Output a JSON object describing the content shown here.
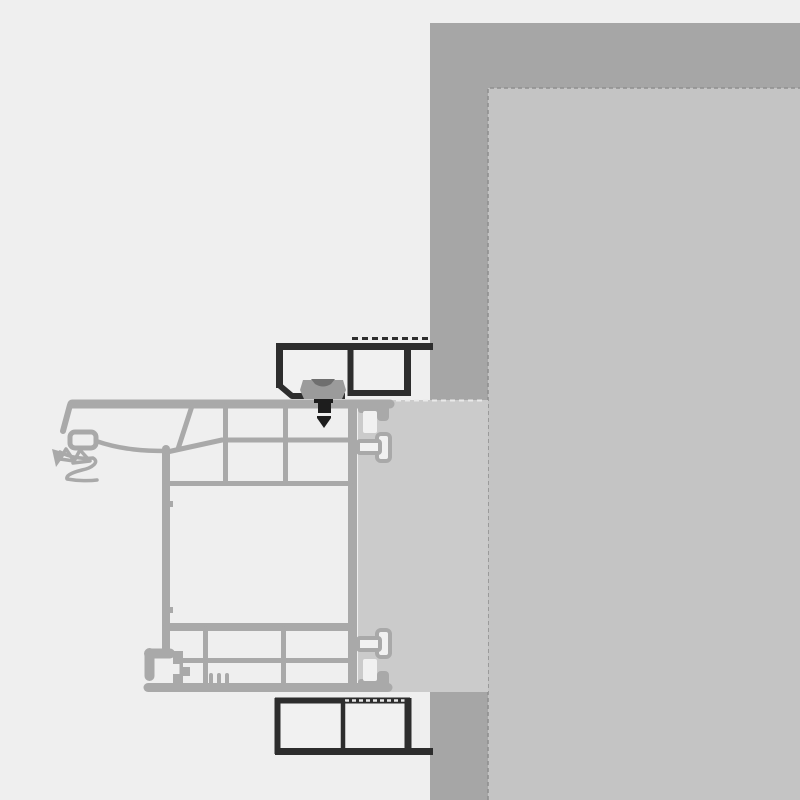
{
  "drawing": {
    "kind": "technical-cross-section",
    "subject": "window-frame-installation-detail",
    "components": {
      "wall": "masonry-wall",
      "wall_inner": "interior-plaster-surface",
      "block": "mounting-filler-block",
      "frame": "window-frame-profile",
      "top_profile": "top-extension-profile",
      "bottom_profile": "bottom-extension-profile",
      "clamp": "fastening-clamp",
      "screw": "fastening-screw",
      "anchors": "frame-anchor-studs",
      "gasket": "outer-gasket-lips"
    }
  },
  "colors": {
    "bg": "#efefef",
    "wall": "#a6a6a6",
    "wall_inner": "#c4c4c4",
    "block": "#cbcbcb",
    "boundary": "#8f8f8f",
    "frame": "#a9a9a9",
    "cell": "#f1f1f1",
    "dark": "#2d2d2d",
    "screw": "#1d1d1d",
    "clamp": "#9b9b9b",
    "clamp_hatch": "#6f6f6f",
    "white_dash": "#e9e9e9"
  }
}
